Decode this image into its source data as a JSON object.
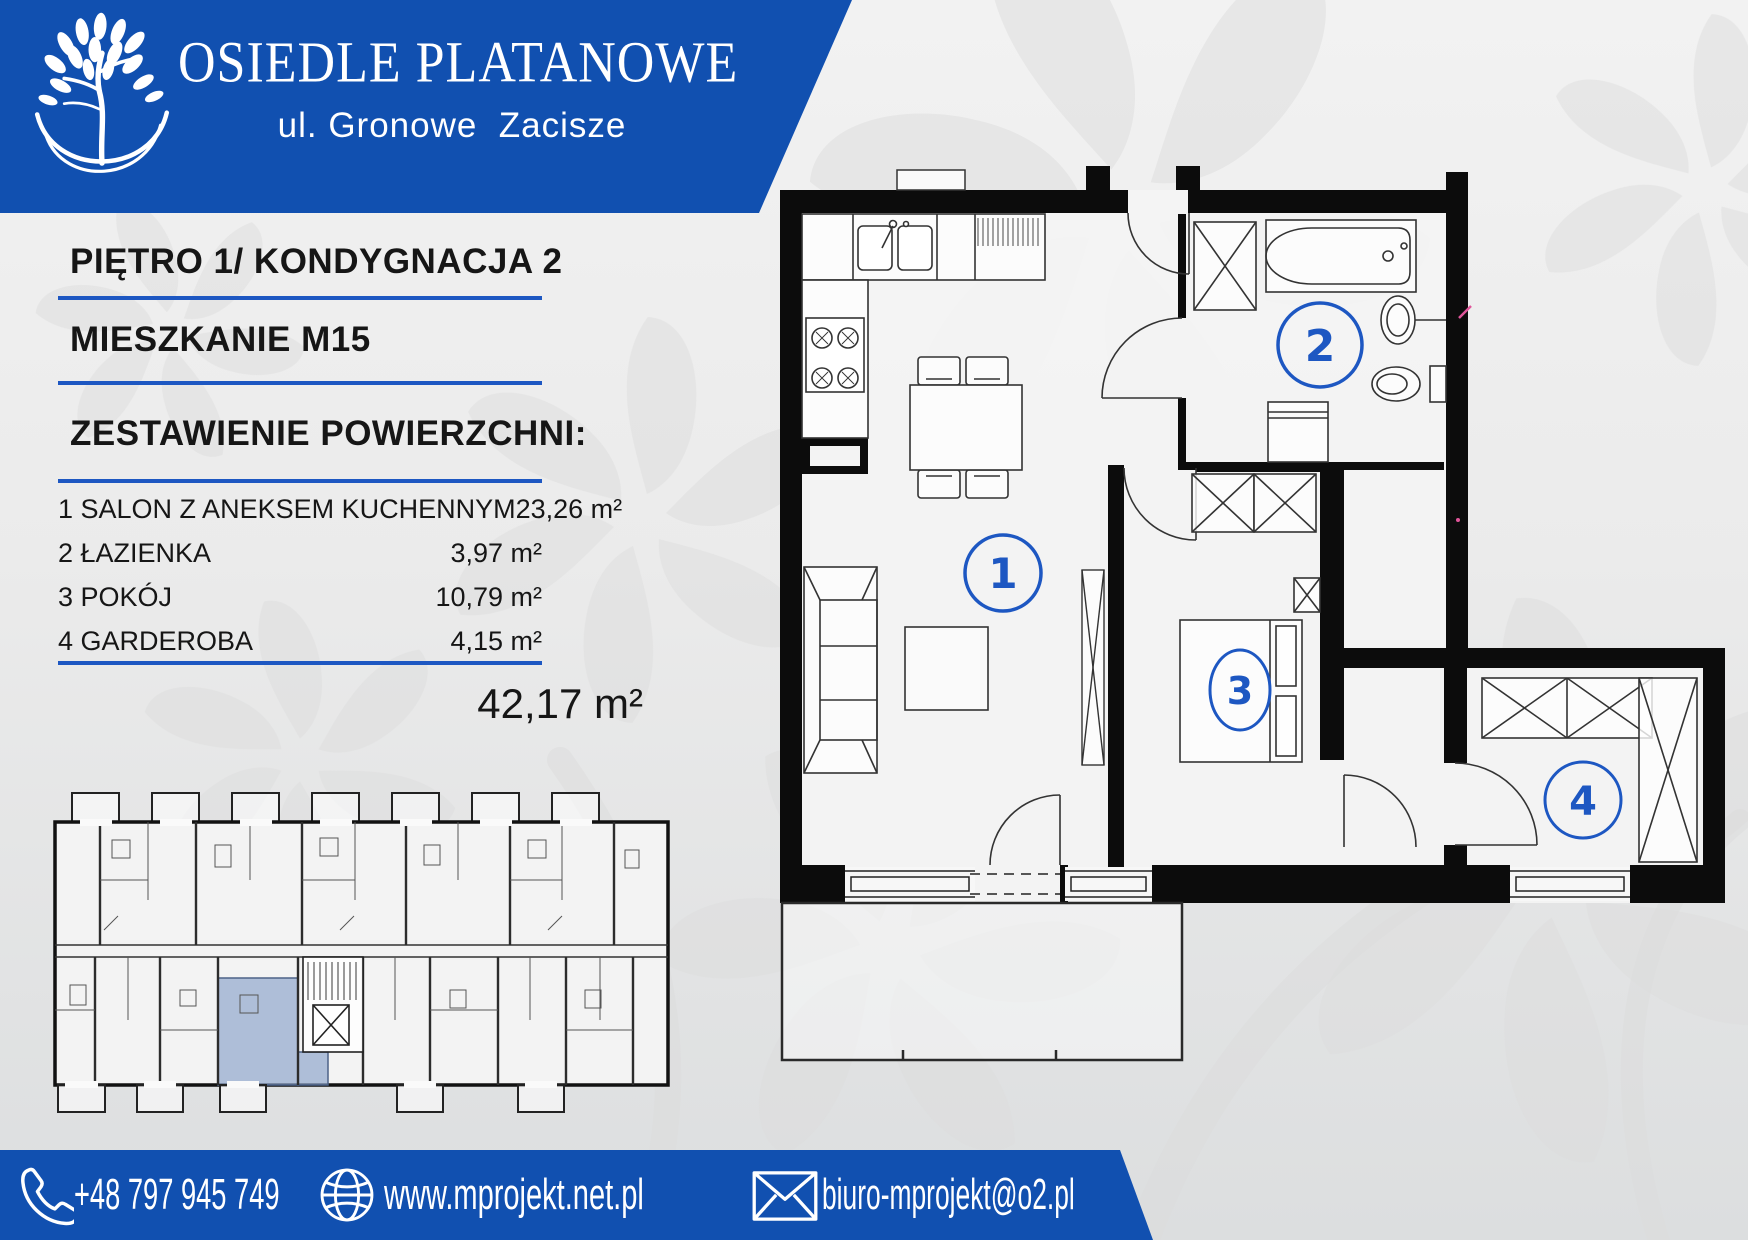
{
  "header": {
    "title": "OSIEDLE PLATANOWE",
    "subtitle": "ul. Gronowe  Zacisze"
  },
  "panel": {
    "floor_line": "PIĘTRO 1/ KONDYGNACJA 2",
    "apartment_line": "MIESZKANIE M15",
    "summary_heading": "ZESTAWIENIE POWIERZCHNI:",
    "rooms": [
      {
        "label": "1 SALON Z ANEKSEM KUCHENNYM",
        "area": "23,26 m²"
      },
      {
        "label": "2 ŁAZIENKA",
        "area": "3,97 m²"
      },
      {
        "label": "3 POKÓJ",
        "area": "10,79 m²"
      },
      {
        "label": "4 GARDEROBA",
        "area": "4,15 m²"
      }
    ],
    "total_area": "42,17 m²"
  },
  "plan": {
    "room1": "1",
    "room2": "2",
    "room3": "3",
    "room4": "4"
  },
  "footer": {
    "phone": "+48 797 945 749",
    "website": "www.mprojekt.net.pl",
    "email": "biuro-mprojekt@o2.pl"
  },
  "icons": {
    "logo": "tree-logo",
    "phone": "phone-icon",
    "website": "globe-icon",
    "email": "envelope-icon"
  },
  "colors": {
    "brand_blue": "#1150b0",
    "accent_line": "#1d57c2",
    "circle_blue": "#1d57c2",
    "unit_highlight": "#8da5cc",
    "wall_black": "#0c0c0c"
  }
}
